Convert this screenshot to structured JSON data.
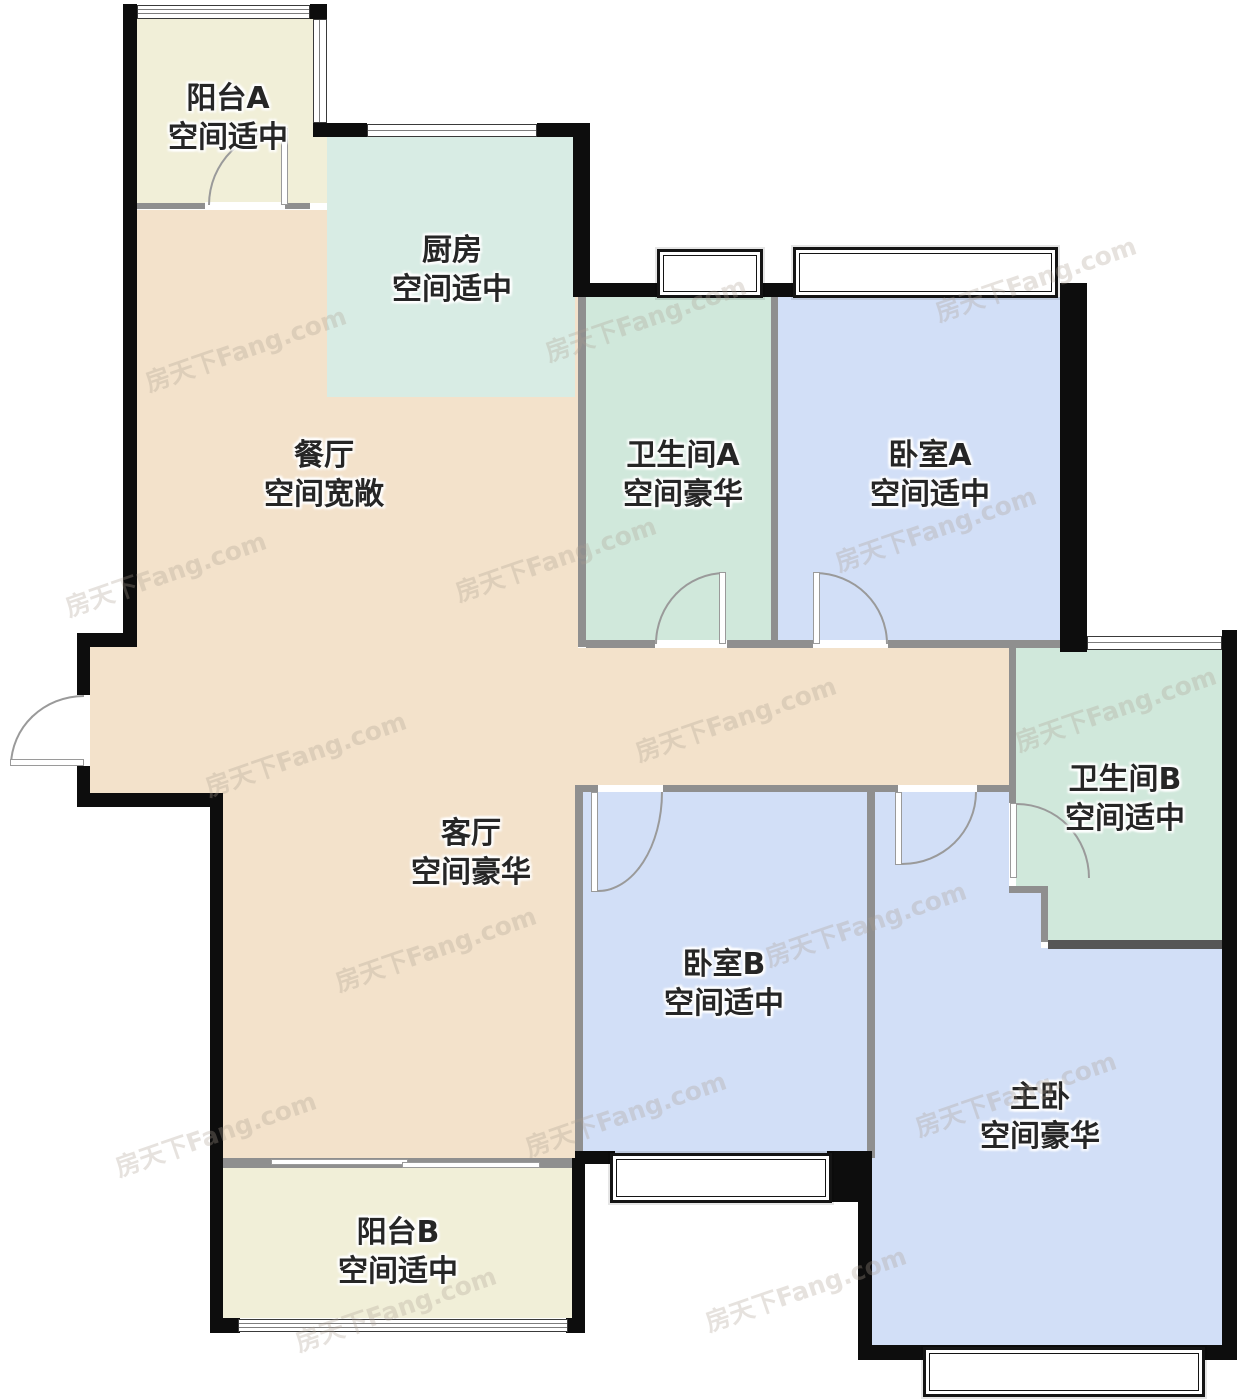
{
  "rooms": [
    {
      "id": "balcony-a",
      "name": "阳台A",
      "size": "空间适中"
    },
    {
      "id": "kitchen",
      "name": "厨房",
      "size": "空间适中"
    },
    {
      "id": "dining",
      "name": "餐厅",
      "size": "空间宽敞"
    },
    {
      "id": "bathroom-a",
      "name": "卫生间A",
      "size": "空间豪华"
    },
    {
      "id": "bedroom-a",
      "name": "卧室A",
      "size": "空间适中"
    },
    {
      "id": "bathroom-b",
      "name": "卫生间B",
      "size": "空间适中"
    },
    {
      "id": "living",
      "name": "客厅",
      "size": "空间豪华"
    },
    {
      "id": "bedroom-b",
      "name": "卧室B",
      "size": "空间适中"
    },
    {
      "id": "master",
      "name": "主卧",
      "size": "空间豪华"
    },
    {
      "id": "balcony-b",
      "name": "阳台B",
      "size": "空间适中"
    }
  ],
  "colors": {
    "exterior_wall": "#0d0d0d",
    "partition_wall": "#8f8f8f",
    "dark_partition": "#565656",
    "balcony_fill": "#f1efd8",
    "kitchen_fill": "#d8ece4",
    "bathroom_fill": "#d0e8db",
    "hall_fill": "#f3e2cb",
    "bedroom_fill": "#d2dff7",
    "door_arc": "#9a9a9a"
  },
  "watermark": {
    "text": "房天下Fang.com",
    "positions": [
      [
        140,
        330
      ],
      [
        540,
        300
      ],
      [
        930,
        260
      ],
      [
        60,
        555
      ],
      [
        450,
        540
      ],
      [
        830,
        510
      ],
      [
        200,
        735
      ],
      [
        630,
        700
      ],
      [
        1010,
        690
      ],
      [
        330,
        930
      ],
      [
        760,
        905
      ],
      [
        110,
        1115
      ],
      [
        520,
        1095
      ],
      [
        910,
        1075
      ],
      [
        290,
        1290
      ],
      [
        700,
        1270
      ]
    ]
  }
}
